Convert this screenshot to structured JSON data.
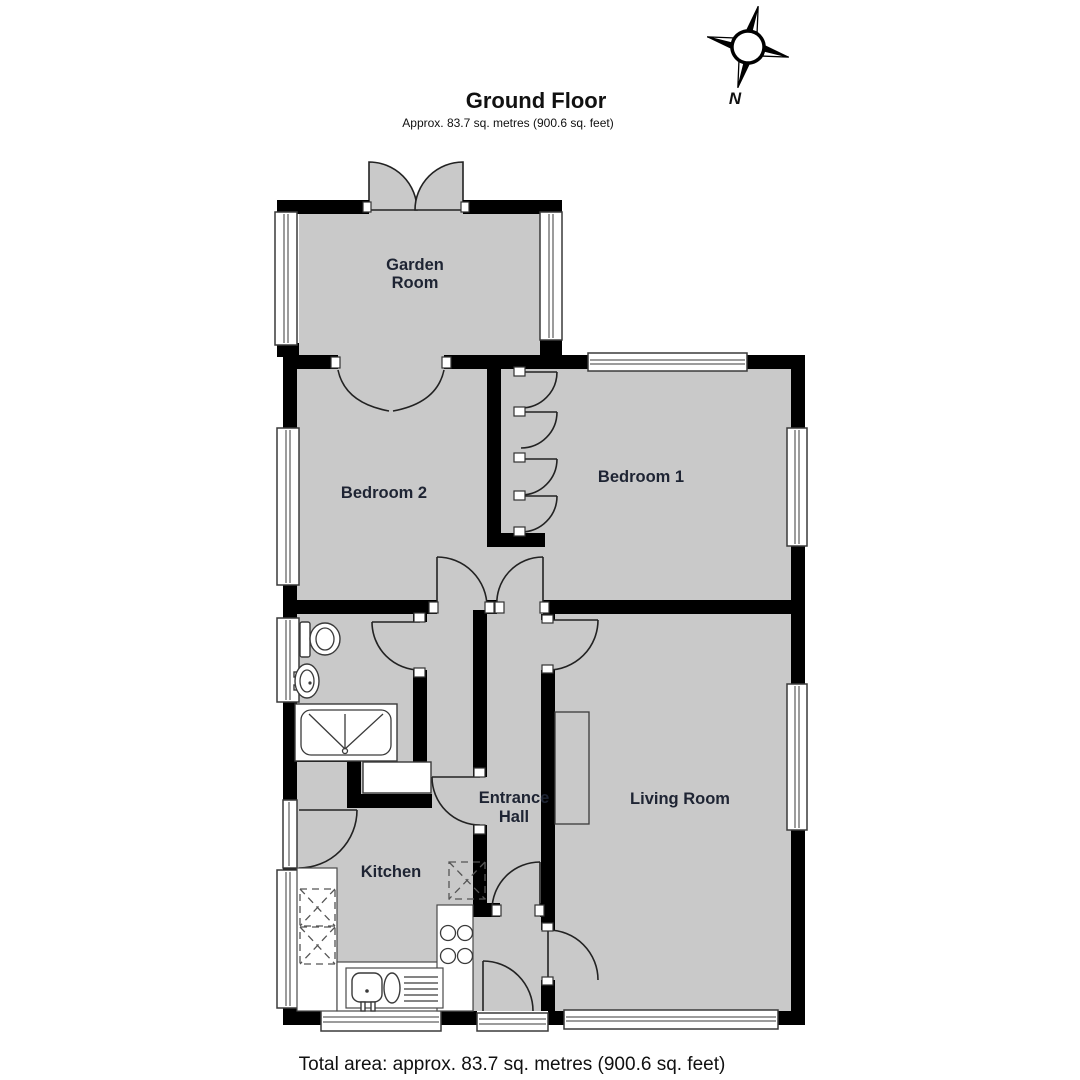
{
  "header": {
    "title": "Ground Floor",
    "subtitle": "Approx. 83.7 sq. metres (900.6 sq. feet)"
  },
  "footer": {
    "total_area": "Total area: approx. 83.7 sq. metres (900.6 sq. feet)"
  },
  "compass": {
    "north_label": "N"
  },
  "rooms": {
    "garden_room": {
      "label_line1": "Garden",
      "label_line2": "Room"
    },
    "bedroom2": {
      "label": "Bedroom 2"
    },
    "bedroom1": {
      "label": "Bedroom 1"
    },
    "living_room": {
      "label": "Living Room"
    },
    "entrance_hall": {
      "label_line1": "Entrance",
      "label_line2": "Hall"
    },
    "kitchen": {
      "label": "Kitchen"
    }
  },
  "colors": {
    "floor": "#c9c9c9",
    "wall": "#000000",
    "label": "#1e2433",
    "fixture_stroke": "#3a3a3a",
    "background": "#ffffff"
  }
}
